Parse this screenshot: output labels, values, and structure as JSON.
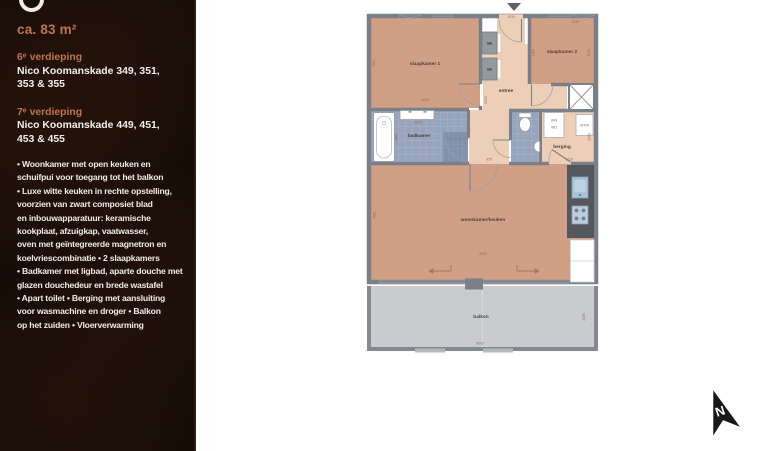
{
  "sidebar": {
    "area_label": "ca. 83 m²",
    "floors": [
      {
        "title": "6ᵉ verdieping",
        "address_line1": "Nico Koomanskade 349, 351,",
        "address_line2": "353 & 355"
      },
      {
        "title": "7ᵉ verdieping",
        "address_line1": "Nico Koomanskade 449, 451,",
        "address_line2": "453 & 455"
      }
    ],
    "description": "• Woonkamer met open keuken en\nschuifpui voor toegang tot het balkon\n• Luxe witte keuken in rechte opstelling,\nvoorzien van zwart composiet blad\nen inbouwapparatuur: keramische\nkookplaat, afzuigkap, vaatwasser,\noven met geïntegreerde magnetron en\nkoelvriescombinatie • 2 slaapkamers\n• Badkamer met ligbad, aparte douche met\nglazen douchedeur en brede wastafel\n• Apart toilet • Berging met aansluiting\nvoor wasmachine en droger • Balkon\nop het zuiden • Vloerverwarming"
  },
  "floorplan": {
    "rooms": {
      "slaapkamer1": "slaapkamer 1",
      "slaapkamer2": "slaapkamer 2",
      "entree": "entree",
      "badkamer": "badkamer",
      "berging": "berging",
      "woonkamer": "woonkamer/keuken",
      "balkon": "balkon"
    },
    "closets": {
      "mk1": "mk",
      "mk2": "mk"
    },
    "appliances": {
      "wm": "WM",
      "wd": "WD",
      "wtw": "WTW"
    },
    "dimensions": {
      "entree_top": "1034",
      "slk2_top": "2198",
      "slk1_w": "4020",
      "slk1_h": "3081",
      "slk2_left": "1460",
      "slk2_right": "3440",
      "entree_mid": "5055",
      "hal_onder": "975",
      "badkamer_w": "1620",
      "badkamer_h": "2085",
      "berging_w": "1720",
      "berging_h": "2005",
      "woon_w": "6320",
      "woon_h": "4581",
      "balkon_w": "8600",
      "balkon_h": "2400"
    },
    "compass_label": "N"
  },
  "colors": {
    "accent_orange": "#c0734c",
    "sidebar_bg": "#170c07",
    "wall_gray": "#7b8088",
    "room_salmon": "#d19f85",
    "room_light": "#edceb6",
    "tile_blue": "#98a4bc",
    "balcony_gray": "#c9cbcf"
  }
}
